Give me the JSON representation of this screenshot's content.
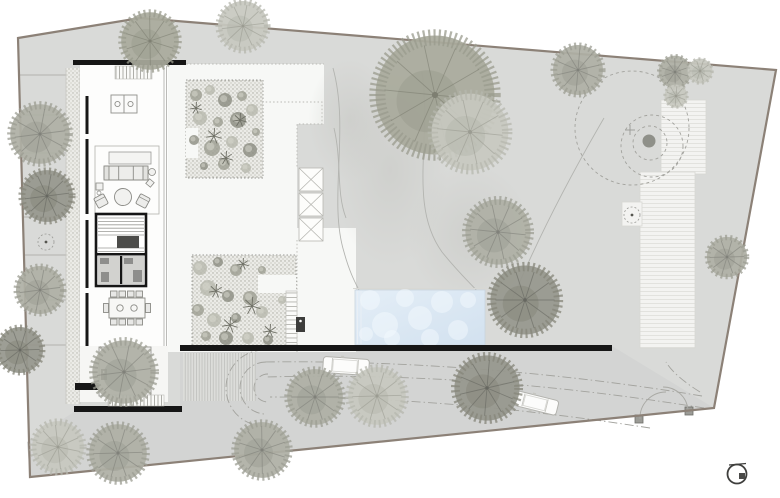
{
  "meta": {
    "title": "Residential architectural site plan — top view",
    "drawing_type": "site / landscape plan",
    "visible_text": "none"
  },
  "palette": {
    "paper": "#ffffff",
    "site_fill": "#d9dad8",
    "driveway_fill": "#d3d4d3",
    "boundary_stroke": "#8c8177",
    "wall_black": "#161616",
    "terrace_white": "#f7f8f6",
    "deck_fill": "#f3f3f1",
    "deck_line": "#e2e2de",
    "bed_fill": "#ebebe7",
    "pool_water": "#dde9f4",
    "pool_bubble": "#f4f9fd",
    "dash_line": "#a3a39e",
    "contour_line": "#b3b4b0"
  },
  "site": {
    "boundary_points": "18,38 140,18 776,70 714,408 30,477",
    "driveway_points": "180,352 612,346 714,408 30,477 27,442 74,412 180,412"
  },
  "left_strips": {
    "x_end": 66,
    "lines": [
      [
        19,
        75
      ],
      [
        20,
        115
      ],
      [
        21,
        153
      ],
      [
        23,
        217
      ],
      [
        24,
        255
      ],
      [
        25,
        300
      ],
      [
        26,
        345
      ]
    ]
  },
  "lawn_contours": [
    "M 333 68 C 350 130 328 200 344 252 C 350 274 356 284 360 292",
    "M 422 72 C 432 140 408 205 442 252 C 458 272 470 283 480 294",
    "M 604 118 C 562 190 532 252 512 300",
    "M 334 128 C 342 162 336 192 346 218"
  ],
  "dashed_circles": [
    {
      "cx": 632,
      "cy": 128,
      "r": 57
    },
    {
      "cx": 652,
      "cy": 146,
      "r": 31
    },
    {
      "cx": 650,
      "cy": 143,
      "r": 17
    }
  ],
  "survey_dot": {
    "cx": 649,
    "cy": 141,
    "r": 6.5,
    "fill": "#8f9089"
  },
  "survey_cross": {
    "cx": 630,
    "cy": 130,
    "size": 5
  },
  "planter_circles": [
    {
      "cx": 46,
      "cy": 242,
      "r": 8
    },
    {
      "cx": 632,
      "cy": 215,
      "r": 8
    }
  ],
  "tree_tones": {
    "olive": {
      "fill": "#a9aa9c",
      "fuzz": "#9a9b8d",
      "branch": "#7e7f72"
    },
    "light": {
      "fill": "#c7c8c0",
      "fuzz": "#b6b7ae",
      "branch": "#9b9c92"
    },
    "mid": {
      "fill": "#aeafa5",
      "fuzz": "#9c9d93",
      "branch": "#80817a"
    },
    "dark": {
      "fill": "#96978d",
      "fuzz": "#858679",
      "branch": "#666760"
    }
  },
  "trees": [
    [
      150,
      41,
      30,
      "olive"
    ],
    [
      243,
      26,
      26,
      "light"
    ],
    [
      40,
      134,
      31,
      "mid"
    ],
    [
      47,
      196,
      27,
      "dark"
    ],
    [
      40,
      290,
      25,
      "mid"
    ],
    [
      20,
      350,
      24,
      "dark"
    ],
    [
      124,
      372,
      33,
      "mid"
    ],
    [
      58,
      447,
      27,
      "light"
    ],
    [
      118,
      453,
      30,
      "mid"
    ],
    [
      262,
      450,
      29,
      "mid"
    ],
    [
      315,
      397,
      29,
      "mid"
    ],
    [
      377,
      396,
      30,
      "light"
    ],
    [
      487,
      388,
      34,
      "dark"
    ],
    [
      435,
      95,
      62,
      "olive"
    ],
    [
      470,
      132,
      40,
      "light"
    ],
    [
      578,
      70,
      26,
      "mid"
    ],
    [
      675,
      72,
      17,
      "mid"
    ],
    [
      700,
      71,
      13,
      "light"
    ],
    [
      676,
      96,
      12,
      "light"
    ],
    [
      498,
      232,
      34,
      "mid"
    ],
    [
      525,
      300,
      36,
      "dark"
    ],
    [
      727,
      257,
      21,
      "mid"
    ]
  ],
  "pool": {
    "x": 355,
    "y": 290,
    "w": 130,
    "h": 55,
    "bubbles": [
      [
        370,
        300,
        10
      ],
      [
        385,
        325,
        13
      ],
      [
        405,
        298,
        9
      ],
      [
        420,
        318,
        12
      ],
      [
        442,
        302,
        11
      ],
      [
        458,
        330,
        10
      ],
      [
        468,
        300,
        8
      ],
      [
        392,
        338,
        8
      ],
      [
        430,
        338,
        9
      ],
      [
        366,
        334,
        7
      ]
    ]
  },
  "driveway": {
    "dash_paths": [
      "M 702 396 C 560 372 400 360 264 362",
      "M 704 408 C 560 385 420 373 266 377",
      "M 650 428 C 520 408 400 397 270 397",
      "M 700 392 C 684 382 672 372 666 362"
    ],
    "turn_arcs": [
      "M 266 362 A 26 26 0 0 0 240 388 A 26 26 0 0 0 266 414",
      "M 268 374 A 14 14 0 0 0 254 388 A 14 14 0 0 0 268 402",
      "M 264 350 A 38 38 0 0 0 226 388 A 38 38 0 0 0 264 426"
    ],
    "cars": [
      {
        "x": 346,
        "y": 366,
        "w": 46,
        "h": 16,
        "angle": 4
      },
      {
        "x": 536,
        "y": 403,
        "w": 44,
        "h": 15,
        "angle": 14
      }
    ]
  },
  "gate": {
    "posts": [
      [
        635,
        415
      ],
      [
        685,
        407
      ]
    ],
    "leaf_paths": [
      "M 640 419 A 26 26 0 0 1 666 392",
      "M 688 410 A 25 25 0 0 0 663 387"
    ]
  },
  "plants": {
    "upper_bed": [
      [
        196,
        95,
        6
      ],
      [
        210,
        90,
        5
      ],
      [
        225,
        100,
        7
      ],
      [
        242,
        96,
        5
      ],
      [
        252,
        110,
        6
      ],
      [
        238,
        120,
        8
      ],
      [
        218,
        122,
        5
      ],
      [
        200,
        118,
        7
      ],
      [
        194,
        140,
        5
      ],
      [
        212,
        148,
        8
      ],
      [
        232,
        142,
        6
      ],
      [
        250,
        150,
        7
      ],
      [
        224,
        164,
        6
      ],
      [
        246,
        168,
        5
      ],
      [
        204,
        166,
        4
      ],
      [
        256,
        132,
        4
      ]
    ],
    "courtyard_bed": [
      [
        200,
        268,
        7
      ],
      [
        218,
        262,
        5
      ],
      [
        236,
        270,
        6
      ],
      [
        208,
        288,
        8
      ],
      [
        228,
        296,
        6
      ],
      [
        198,
        310,
        6
      ],
      [
        214,
        320,
        7
      ],
      [
        236,
        318,
        5
      ],
      [
        250,
        298,
        7
      ],
      [
        262,
        312,
        6
      ],
      [
        226,
        338,
        7
      ],
      [
        206,
        336,
        5
      ],
      [
        248,
        338,
        6
      ],
      [
        268,
        340,
        5
      ],
      [
        262,
        270,
        4
      ],
      [
        282,
        300,
        4
      ]
    ],
    "spikes": [
      [
        252,
        306,
        9
      ],
      [
        230,
        325,
        8
      ],
      [
        270,
        331,
        7
      ],
      [
        216,
        291,
        7
      ],
      [
        243,
        264,
        6
      ],
      [
        214,
        136,
        8
      ],
      [
        240,
        120,
        7
      ],
      [
        226,
        158,
        7
      ],
      [
        196,
        108,
        6
      ]
    ]
  },
  "north_symbol": {
    "cx": 737,
    "cy": 474,
    "r": 9.5
  }
}
